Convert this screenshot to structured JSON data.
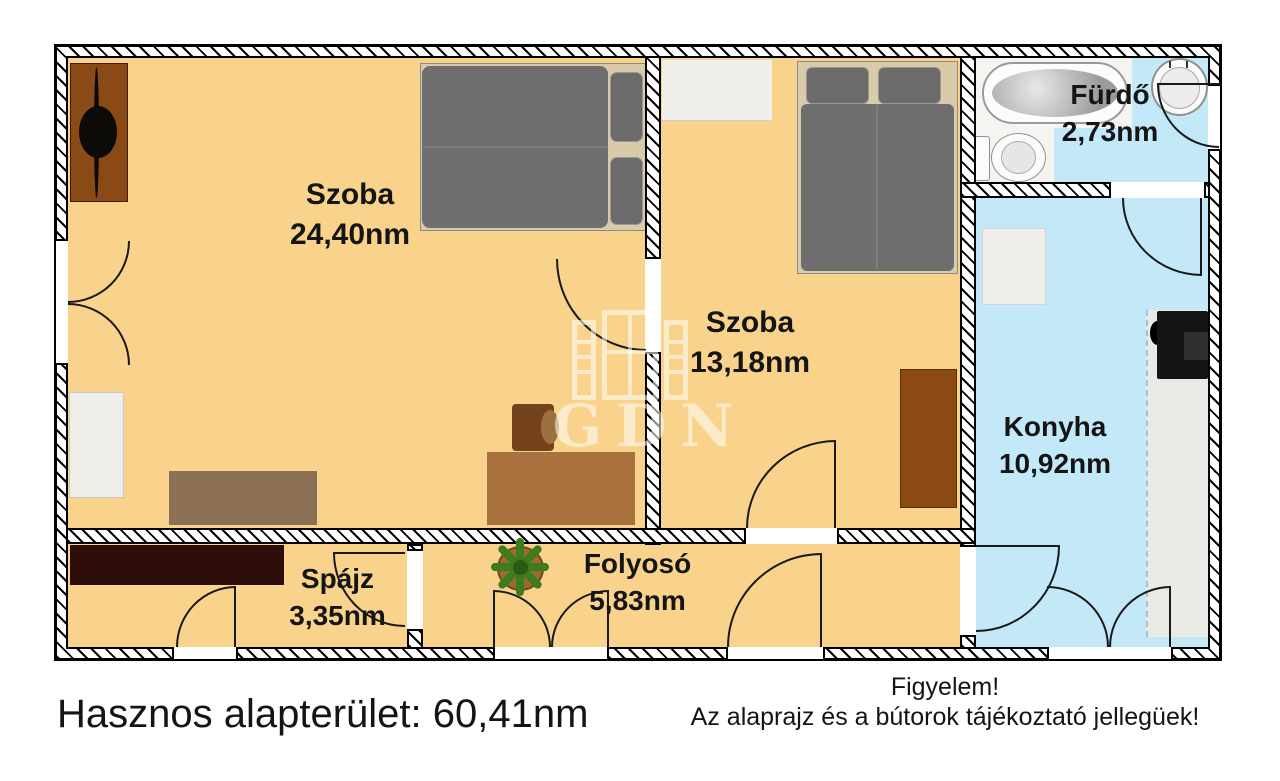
{
  "rooms": [
    {
      "name": "Szoba",
      "area": "24,40nm"
    },
    {
      "name": "Szoba",
      "area": "13,18nm"
    },
    {
      "name": "Fürdő",
      "area": "2,73nm"
    },
    {
      "name": "Konyha",
      "area": "10,92nm"
    },
    {
      "name": "Spájz",
      "area": "3,35nm"
    },
    {
      "name": "Folyosó",
      "area": "5,83nm"
    }
  ],
  "footer": {
    "total_area": "Hasznos alapterület: 60,41nm",
    "warning_title": "Figyelem!",
    "warning_text": "Az alaprajz és a bútorok tájékoztató jellegüek!"
  },
  "watermark": {
    "text": "GDN"
  },
  "colors": {
    "floor": "#F9D38B",
    "wet_floor": "#C3E9F9",
    "wall_line": "#000000",
    "furniture_brown": "#8A4A15",
    "bed_gray": "#6E6E6E"
  }
}
